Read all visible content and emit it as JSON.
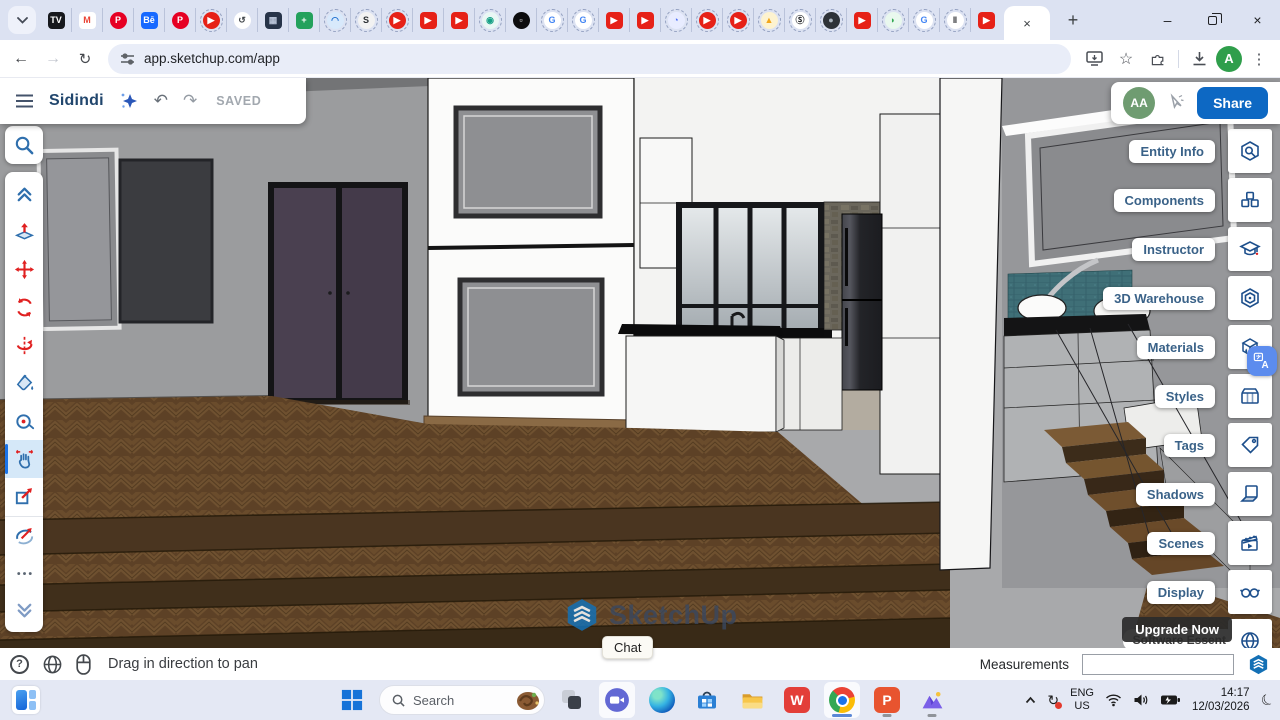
{
  "browser": {
    "nav": {
      "url": "app.sketchup.com/app"
    },
    "profile_initial": "A",
    "active_tab_close": "×",
    "new_tab": "+",
    "window": {
      "minimize": "–",
      "close": "×"
    },
    "pinned_tabs": [
      {
        "glyph": "TV",
        "bg": "#16181d",
        "fg": "#ffffff",
        "cls": "sq"
      },
      {
        "glyph": "M",
        "bg": "#ffffff",
        "fg": "#ea4335",
        "cls": "sq"
      },
      {
        "glyph": "P",
        "bg": "#e60023",
        "fg": "#ffffff",
        "cls": "circle"
      },
      {
        "glyph": "Bē",
        "bg": "#1769ff",
        "fg": "#ffffff",
        "cls": "sq"
      },
      {
        "glyph": "P",
        "bg": "#e60023",
        "fg": "#ffffff",
        "cls": "circle"
      },
      {
        "glyph": "▶",
        "bg": "#e62117",
        "fg": "#ffffff",
        "cls": "circle ring"
      },
      {
        "glyph": "↺",
        "bg": "#ffffff",
        "fg": "#41464b",
        "cls": "circle"
      },
      {
        "glyph": "▦",
        "bg": "#273449",
        "fg": "#b9c4d8",
        "cls": "sq"
      },
      {
        "glyph": "+",
        "bg": "#23a15c",
        "fg": "#ffffff",
        "cls": "sq"
      },
      {
        "glyph": "◠",
        "bg": "#d8e9fb",
        "fg": "#1f6fd0",
        "cls": "circle ring"
      },
      {
        "glyph": "S",
        "bg": "#f2f2f2",
        "fg": "#2b2f33",
        "cls": "circle ring"
      },
      {
        "glyph": "▶",
        "bg": "#e62117",
        "fg": "#ffffff",
        "cls": "circle ring"
      },
      {
        "glyph": "▶",
        "bg": "#e62117",
        "fg": "#ffffff",
        "cls": "sq"
      },
      {
        "glyph": "▶",
        "bg": "#e62117",
        "fg": "#ffffff",
        "cls": "sq"
      },
      {
        "glyph": "◉",
        "bg": "#e9f7f4",
        "fg": "#16a085",
        "cls": "circle ring"
      },
      {
        "glyph": "▫",
        "bg": "#0d0d0f",
        "fg": "#ffffff",
        "cls": "circle"
      },
      {
        "glyph": "G",
        "bg": "#ffffff",
        "fg": "#4285f4",
        "cls": "circle ring"
      },
      {
        "glyph": "G",
        "bg": "#ffffff",
        "fg": "#4285f4",
        "cls": "circle ring"
      },
      {
        "glyph": "▶",
        "bg": "#e62117",
        "fg": "#ffffff",
        "cls": "sq"
      },
      {
        "glyph": "▶",
        "bg": "#e62117",
        "fg": "#ffffff",
        "cls": "sq"
      },
      {
        "glyph": "◔",
        "bg": "#e8ecff",
        "fg": "#4c6ef5",
        "cls": "circle ring"
      },
      {
        "glyph": "▶",
        "bg": "#e62117",
        "fg": "#ffffff",
        "cls": "circle ring"
      },
      {
        "glyph": "▶",
        "bg": "#e62117",
        "fg": "#ffffff",
        "cls": "circle ring"
      },
      {
        "glyph": "▲",
        "bg": "#fdf3d0",
        "fg": "#f2a71b",
        "cls": "circle ring"
      },
      {
        "glyph": "Ⓢ",
        "bg": "#ffffff",
        "fg": "#17191c",
        "cls": "circle ring"
      },
      {
        "glyph": "●",
        "bg": "#2e3338",
        "fg": "#aab4bd",
        "cls": "circle ring"
      },
      {
        "glyph": "▶",
        "bg": "#e62117",
        "fg": "#ffffff",
        "cls": "sq"
      },
      {
        "glyph": "◗",
        "bg": "#e9f8ee",
        "fg": "#34a853",
        "cls": "circle ring"
      },
      {
        "glyph": "G",
        "bg": "#ffffff",
        "fg": "#4285f4",
        "cls": "circle ring"
      },
      {
        "glyph": "‖",
        "bg": "#ffffff",
        "fg": "#24262a",
        "cls": "circle ring"
      },
      {
        "glyph": "▶",
        "bg": "#e62117",
        "fg": "#ffffff",
        "cls": "sq"
      }
    ]
  },
  "sketchup": {
    "header": {
      "title": "Sidindi",
      "saved": "SAVED",
      "share": "Share",
      "avatar": "AA"
    },
    "left_toolbar": {
      "tools": [
        {
          "name": "tool-collapse",
          "icon": "#i-chev-up",
          "cls": ""
        },
        {
          "name": "tool-push-pull",
          "icon": "#i-pushpull",
          "cls": ""
        },
        {
          "name": "tool-move",
          "icon": "#i-move",
          "cls": ""
        },
        {
          "name": "tool-rotate",
          "icon": "#i-rotate",
          "cls": ""
        },
        {
          "name": "tool-flip",
          "icon": "#i-flip",
          "cls": ""
        },
        {
          "name": "tool-paint-bucket",
          "icon": "#i-paint",
          "cls": ""
        },
        {
          "name": "tool-tape-measure",
          "icon": "#i-tape",
          "cls": ""
        },
        {
          "name": "tool-pan",
          "icon": "#i-pan",
          "cls": "active"
        },
        {
          "name": "tool-zoom-window",
          "icon": "#i-zoomwin",
          "cls": ""
        },
        {
          "name": "tool-orbit",
          "icon": "#i-orbit",
          "cls": "sep"
        },
        {
          "name": "tool-more",
          "icon": "#i-more",
          "cls": ""
        },
        {
          "name": "tool-expand",
          "icon": "#i-chev-down",
          "cls": ""
        }
      ]
    },
    "right_panel": {
      "items": [
        {
          "label": "Entity Info",
          "icon": "#i-entity",
          "name": "panel-entity-info"
        },
        {
          "label": "Components",
          "icon": "#i-components",
          "name": "panel-components"
        },
        {
          "label": "Instructor",
          "icon": "#i-instructor",
          "name": "panel-instructor"
        },
        {
          "label": "3D Warehouse",
          "icon": "#i-warehouse",
          "name": "panel-3d-warehouse"
        },
        {
          "label": "Materials",
          "icon": "#i-materials",
          "name": "panel-materials"
        },
        {
          "label": "Styles",
          "icon": "#i-styles",
          "name": "panel-styles"
        },
        {
          "label": "Tags",
          "icon": "#i-tags",
          "name": "panel-tags"
        },
        {
          "label": "Shadows",
          "icon": "#i-shadows",
          "name": "panel-shadows"
        },
        {
          "label": "Scenes",
          "icon": "#i-scenes",
          "name": "panel-scenes"
        },
        {
          "label": "Display",
          "icon": "#i-display",
          "name": "panel-display"
        },
        {
          "label": "",
          "icon": "#i-globe2",
          "name": "panel-language"
        }
      ],
      "upgrade": "Upgrade Now",
      "plan_partial": "Software Essent"
    },
    "status_bar": {
      "hint": "Drag in direction to pan",
      "chat": "Chat",
      "measurements_label": "Measurements",
      "measurements_value": ""
    },
    "watermark": "SketchUp"
  },
  "taskbar": {
    "search_placeholder": "Search",
    "language": {
      "line1": "ENG",
      "line2": "US"
    },
    "clock": {
      "time": "14:17",
      "date": "12/03/2026"
    }
  }
}
